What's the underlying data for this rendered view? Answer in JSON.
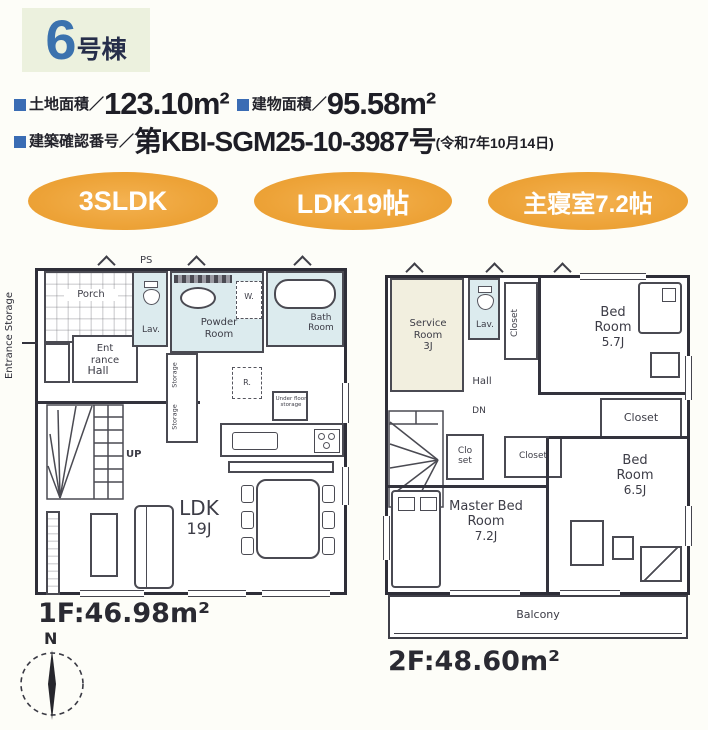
{
  "header": {
    "unit": {
      "number": "6",
      "suffix": "号棟"
    },
    "land": {
      "label": "土地面積／",
      "value": "123.10m²"
    },
    "building": {
      "label": "建物面積／",
      "value": "95.58m²"
    },
    "confirmation": {
      "label": "建築確認番号／",
      "value": "第KBI-SGM25-10-3987号",
      "date": "(令和7年10月14日)"
    },
    "badges": [
      "3SLDK",
      "LDK19帖",
      "主寝室7.2帖"
    ]
  },
  "floor1": {
    "area": "1F:46.98m²",
    "porch": "Porch",
    "entrance": "Ent rance",
    "entrance_storage": "Entrance Storage",
    "lav": "Lav.",
    "powder": "Powder Room",
    "bath": "Bath Room",
    "hall": "Hall",
    "storage": "Storage",
    "washer": "W.",
    "fridge": "R.",
    "ps": "PS",
    "underfloor": "Under floor storage",
    "up": "UP",
    "ldk": "LDK",
    "ldk_size": "19J"
  },
  "floor2": {
    "area": "2F:48.60m²",
    "service": "Service Room",
    "service_size": "3J",
    "lav": "Lav.",
    "closet": "Closet",
    "closet_small": "Clo set",
    "hall": "Hall",
    "dn": "DN",
    "bed": "Bed Room",
    "bed1_size": "5.7J",
    "master": "Master Bed Room",
    "master_size": "7.2J",
    "bed2_size": "6.5J",
    "balcony": "Balcony"
  },
  "compass": {
    "north": "N"
  },
  "colors": {
    "badge_orange": "#eda338",
    "title_blue": "#3b72ae",
    "title_box_green": "#ecf1de",
    "bullet_blue": "#3a6cb4",
    "room_blue": "#dcebee",
    "room_cream": "#f2efdf"
  }
}
